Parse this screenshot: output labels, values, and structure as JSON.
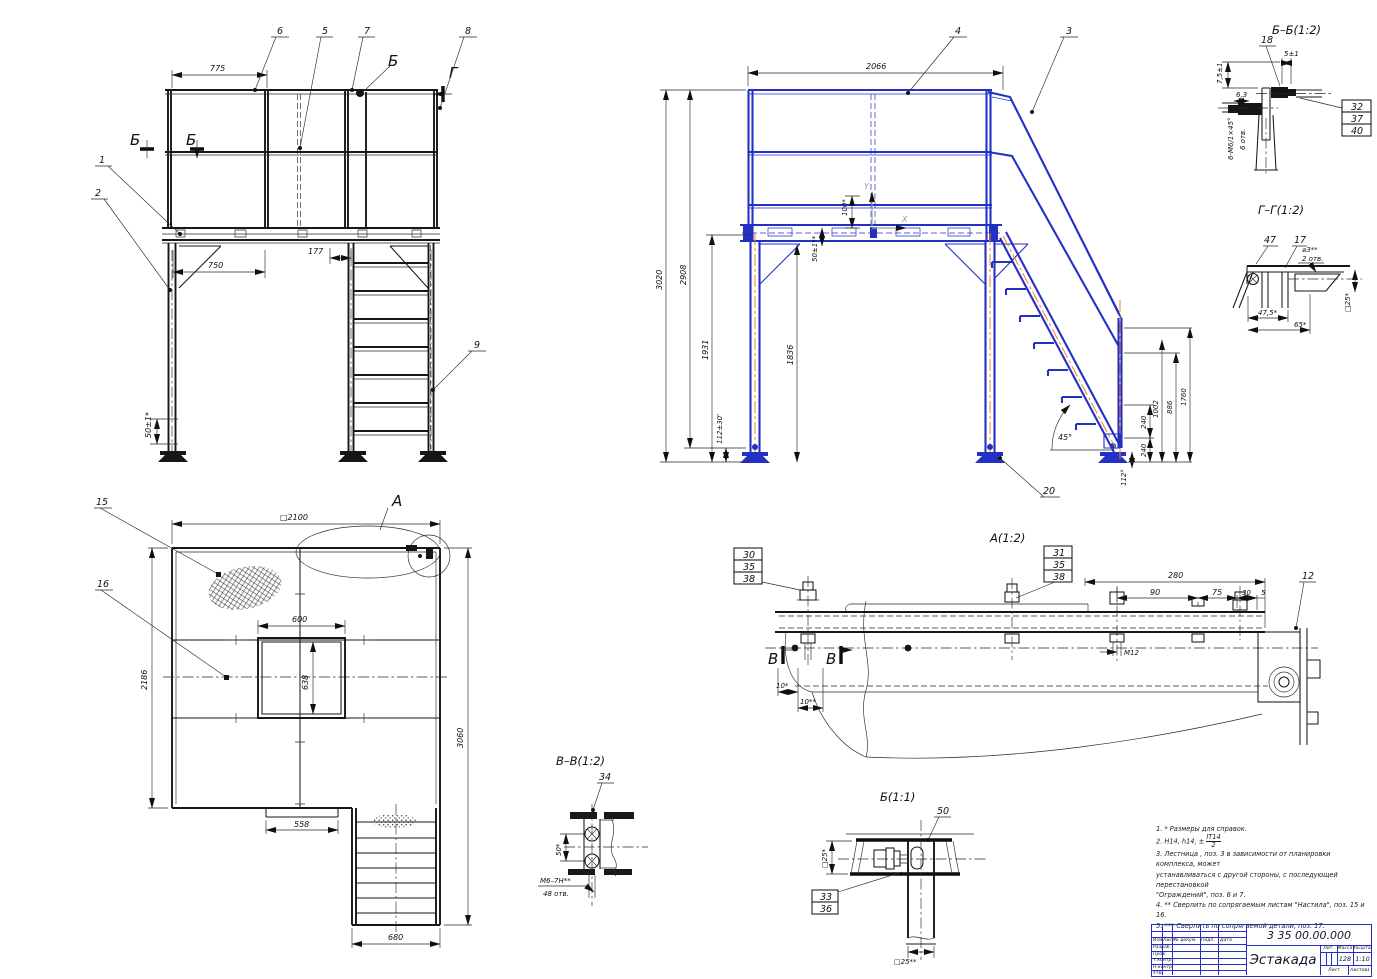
{
  "front": {
    "pos1": "1",
    "pos2": "2",
    "pos5": "5",
    "pos6": "6",
    "pos7": "7",
    "pos8": "8",
    "pos9": "9",
    "cut_b_l1": "Б",
    "cut_b_l2": "Б",
    "cut_b_top": "Б",
    "cut_g": "Г",
    "d775": "775",
    "d750": "750",
    "d177": "177",
    "d50": "50±1*"
  },
  "side": {
    "pos3": "3",
    "pos4": "4",
    "pos20": "20",
    "d2066": "2066",
    "d3020": "3020",
    "d2908": "2908",
    "d1931": "1931",
    "d1836": "1836",
    "d112": "112±30'",
    "d100": "100*",
    "d50": "50±1**",
    "d240a": "240",
    "d1002": "1002",
    "d240b": "240",
    "d886": "886",
    "d1760": "1760",
    "a45": "45°",
    "a112": "112°",
    "axis_x": "X",
    "axis_y": "Y"
  },
  "sec_bb": {
    "title": "Б–Б(1:2)",
    "pos18": "18",
    "d5": "5±1",
    "d75": "7,5±1",
    "d63": "6,3",
    "callout": "6-М6/1×45°",
    "holes": "6 отв.",
    "s1": "32",
    "s2": "37",
    "s3": "40"
  },
  "sec_gg": {
    "title": "Г–Г(1:2)",
    "pos47": "47",
    "pos17": "17",
    "dhole": "⌀3**",
    "holes": "2 отв.",
    "d475": "47,5*",
    "d65": "65*",
    "d25": "□25*"
  },
  "plan": {
    "pos15": "15",
    "pos16": "16",
    "mark_a": "A",
    "d2100": "□2100",
    "d600": "600",
    "d638": "638",
    "d2186": "2186",
    "d3060": "3060",
    "d558": "558",
    "d680": "680"
  },
  "det_a": {
    "title": "A(1:2)",
    "sl1": "30",
    "sl2": "35",
    "sl3": "38",
    "sr1": "31",
    "sr2": "35",
    "sr3": "38",
    "pos12": "12",
    "d280": "280",
    "d90": "90",
    "d75": "75",
    "d30": "30",
    "d5": "5",
    "m12": "М12",
    "d10a": "10*",
    "d10b": "10**",
    "cut_v1": "В",
    "cut_v2": "В"
  },
  "sec_vv": {
    "title": "В–В(1:2)",
    "pos34": "34",
    "d50": "50*",
    "thread": "М6–7Н**",
    "holes": "48 отв."
  },
  "det_b": {
    "title": "Б(1:1)",
    "pos50": "50",
    "s1": "33",
    "s2": "36",
    "d25a": "□25*",
    "d25b": "□25**"
  },
  "notes": {
    "n1": "1.  * Размеры для справок.",
    "n2_pre": "2.  H14, h14, ±",
    "n2_num": "IT14",
    "n2_den": "2",
    "n3a": "3. Лестница , поз. 3 в зависимости от планировки комплекса, может",
    "n3b": "устанавливаться с другой стороны, с последующей перестановкой",
    "n3c": "\"Ограждений\", поз. 6 и 7.",
    "n4": "4.  ** Сверлить по сопрягаемым листам \"Настила\", поз. 15 и 16.",
    "n5": "5.  *** Сверлить по сопрягаемой детали, поз. 17."
  },
  "tb": {
    "doc": "3 35 00.00.000",
    "name": "Эстакада",
    "h_izm": "Изм.",
    "h_list": "Лист",
    "h_doc": "№ докум.",
    "h_sign": "Подп.",
    "h_date": "Дата",
    "r1": "Разраб.",
    "r2": "Пров.",
    "r3": "Т.контр.",
    "r4": "Н.контр.",
    "r5": "Утв.",
    "h_lit": "Лит.",
    "h_mass": "Масса",
    "h_scale": "Масштаб",
    "mass": "128",
    "scale": "1:10",
    "f_sheet": "Лист",
    "f_sheets": "Листов",
    "sheets_val": "1"
  }
}
